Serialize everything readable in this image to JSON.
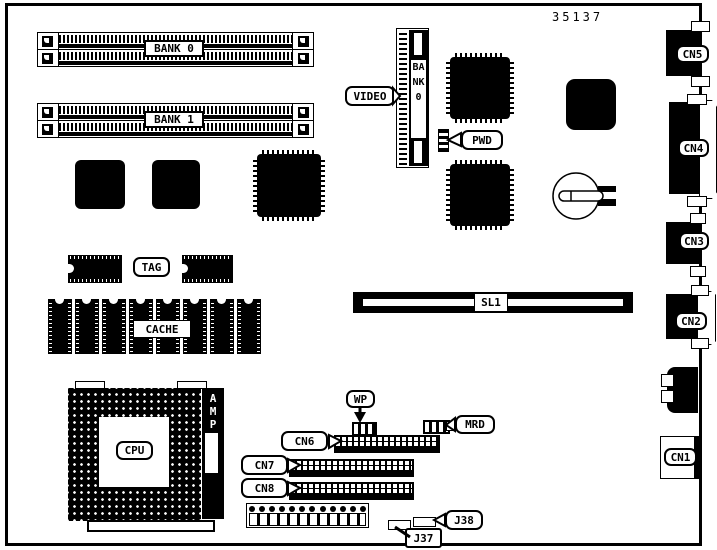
{
  "diagram": {
    "part_number": "35137"
  },
  "memory": {
    "bank0_label": "BANK 0",
    "bank1_label": "BANK 1"
  },
  "video": {
    "callout_label": "VIDEO",
    "slot_label": "BANK0"
  },
  "cache": {
    "tag_label": "TAG",
    "cache_label": "CACHE"
  },
  "cpu": {
    "label": "CPU",
    "amp_label": "AMP"
  },
  "slot": {
    "sl1_label": "SL1"
  },
  "jumpers": {
    "pwd": "PWD",
    "wp": "WP",
    "mrd": "MRD",
    "j37": "J37",
    "j38": "J38"
  },
  "connectors": {
    "cn1": "CN1",
    "cn2": "CN2",
    "cn3": "CN3",
    "cn4": "CN4",
    "cn5": "CN5",
    "cn6": "CN6",
    "cn7": "CN7",
    "cn8": "CN8"
  }
}
